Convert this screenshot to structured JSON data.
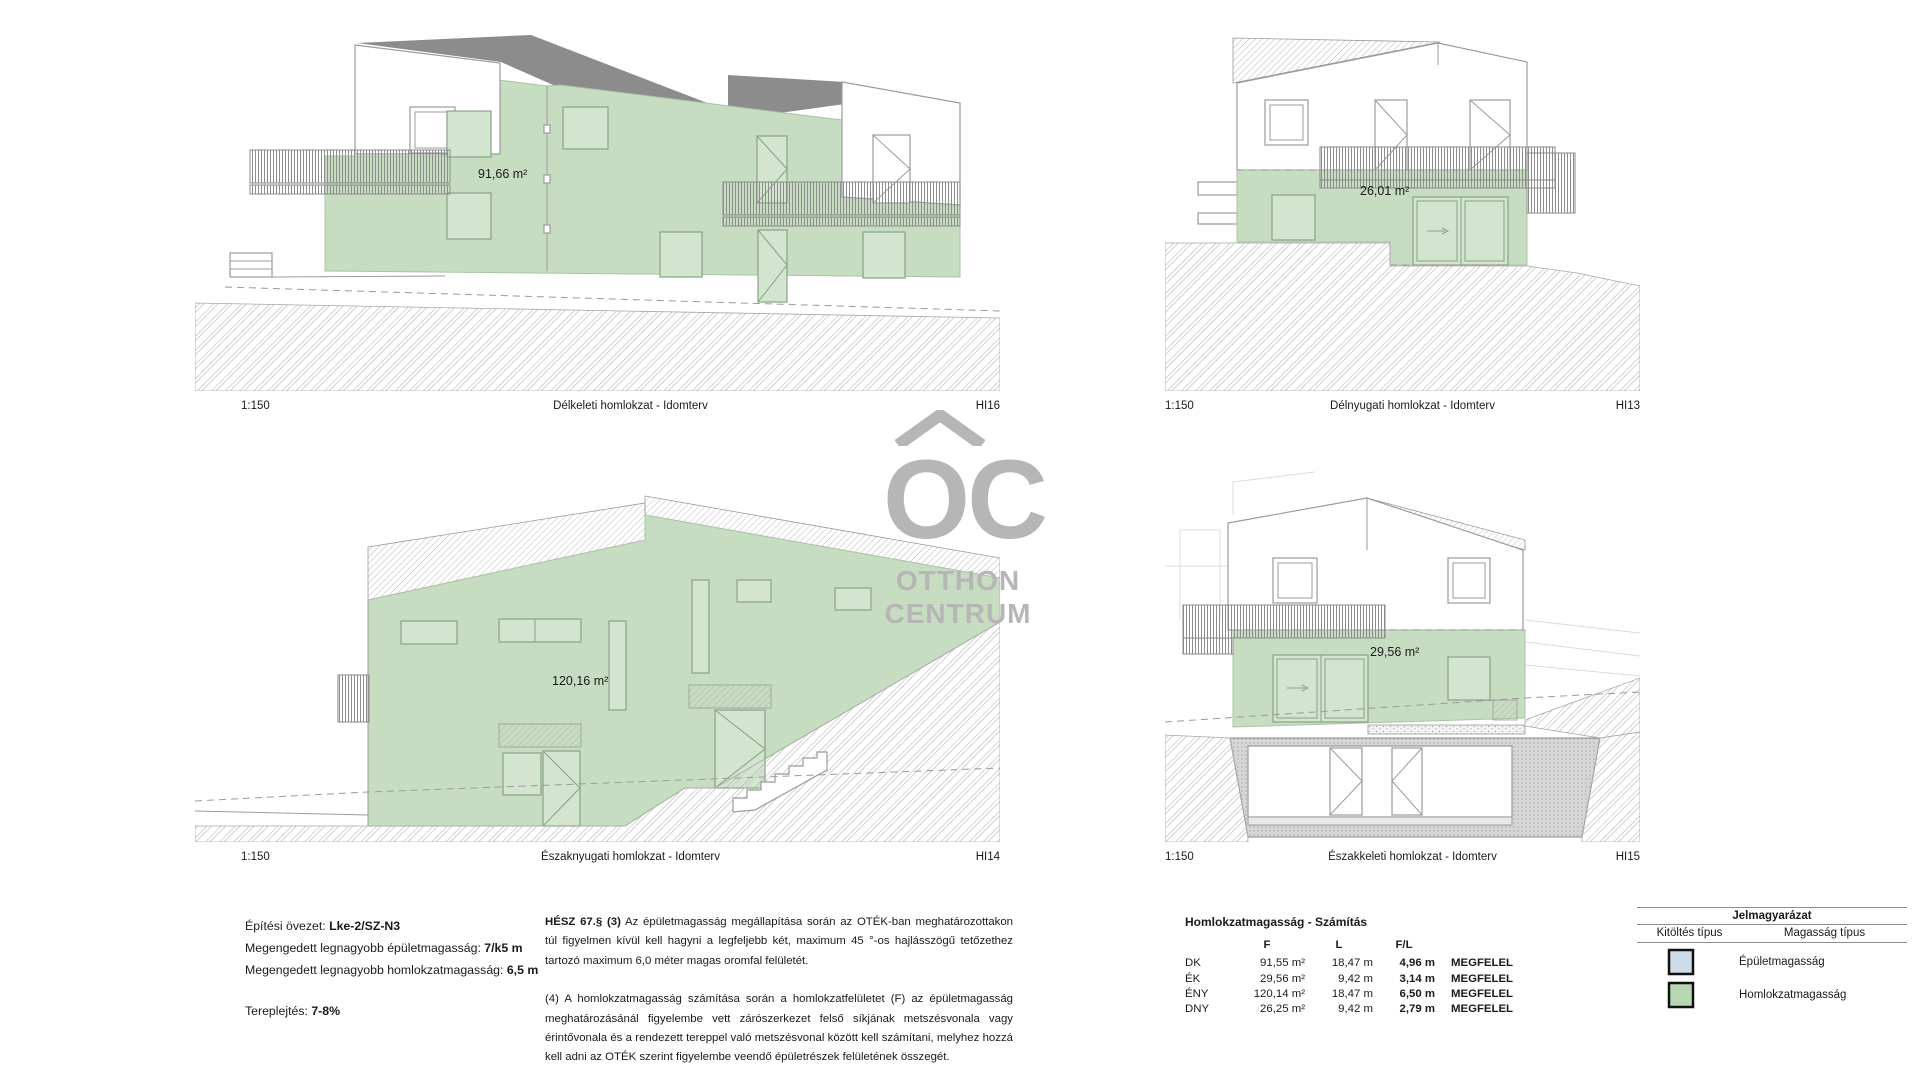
{
  "watermark": {
    "oc": "OC",
    "line1": "OTTHON",
    "line2": "CENTRUM"
  },
  "drawings": [
    {
      "scale": "1:150",
      "title": "Délkeleti homlokzat - Idomterv",
      "code": "HI16",
      "area": "91,66 m²"
    },
    {
      "scale": "1:150",
      "title": "Délnyugati homlokzat - Idomterv",
      "code": "HI13",
      "area": "26,01 m²"
    },
    {
      "scale": "1:150",
      "title": "Északnyugati homlokzat - Idomterv",
      "code": "HI14",
      "area": "120,16 m²"
    },
    {
      "scale": "1:150",
      "title": "Északkeleti homlokzat - Idomterv",
      "code": "HI15",
      "area": "29,56 m²"
    }
  ],
  "zoning": {
    "l1": "Építési övezet: ",
    "v1": "Lke-2/SZ-N3",
    "l2": "Megengedett legnagyobb épületmagasság: ",
    "v2": "7/k5 m",
    "l3": "Megengedett legnagyobb homlokzatmagasság: ",
    "v3": "6,5 m",
    "l4": "Tereplejtés: ",
    "v4": "7-8%"
  },
  "regulation": {
    "bold": "HÉSZ 67.§ (3)",
    "para1": " Az épületmagasság megállapítása során az OTÉK-ban meghatározottakon túl figyelmen kívül kell  hagyni a legfeljebb két, maximum 45 °-os hajlásszögű tetőzethez tartozó maximum 6,0 méter magas oromfal felületét.",
    "para2": "(4) A homlokzatmagasság számítása során a homlokzatfelületet (F) az épületmagasság meghatározásánál figyelembe vett zárószerkezet felső síkjának metszésvonala vagy érintővonala és a rendezett tereppel való metszésvonal között kell számítani, melyhez hozzá kell adni az OTÉK szerint figyelembe veendő épületrészek felületének összegét."
  },
  "calculation": {
    "title": "Homlokzatmagasság - Számítás",
    "col_f": "F",
    "col_l": "L",
    "col_fl": "F/L",
    "rows": [
      {
        "dir": "DK",
        "f": "91,55 m²",
        "l": "18,47 m",
        "fl": "4,96 m",
        "status": "MEGFELEL"
      },
      {
        "dir": "ÉK",
        "f": "29,56 m²",
        "l": "9,42 m",
        "fl": "3,14 m",
        "status": "MEGFELEL"
      },
      {
        "dir": "ÉNY",
        "f": "120,14 m²",
        "l": "18,47 m",
        "fl": "6,50 m",
        "status": "MEGFELEL"
      },
      {
        "dir": "DNY",
        "f": "26,25 m²",
        "l": "9,42 m",
        "fl": "2,79 m",
        "status": "MEGFELEL"
      }
    ]
  },
  "legend": {
    "title": "Jelmagyarázat",
    "col_fill": "Kitöltés típus",
    "col_height": "Magasság típus",
    "items": [
      {
        "label": "Épületmagasság",
        "color": "#cedbe9"
      },
      {
        "label": "Homlokzatmagasság",
        "color": "#b7d7b2"
      }
    ]
  },
  "colors": {
    "facade_highlight": "#c7ddc2",
    "roof_gray": "#8c8c8c",
    "watermark_gray": "#b6b6b6"
  }
}
